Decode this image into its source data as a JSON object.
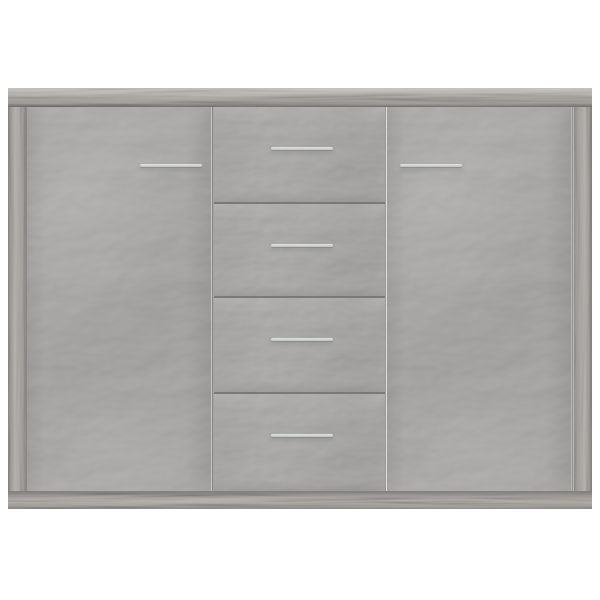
{
  "scene": {
    "description": "Sideboard cabinet in concrete grey, front view, on plain white background",
    "background_color": "#ffffff"
  },
  "cabinet": {
    "finish": "concrete grey",
    "top_board": {
      "name": "top-board"
    },
    "side_panels": [
      {
        "name": "left-side-panel"
      },
      {
        "name": "right-side-panel"
      }
    ],
    "doors": [
      {
        "name": "left-door",
        "handle": "metal-bar-handle"
      },
      {
        "name": "right-door",
        "handle": "metal-bar-handle"
      }
    ],
    "drawers": [
      {
        "name": "drawer-1",
        "handle": "metal-bar-handle"
      },
      {
        "name": "drawer-2",
        "handle": "metal-bar-handle"
      },
      {
        "name": "drawer-3",
        "handle": "metal-bar-handle"
      },
      {
        "name": "drawer-4",
        "handle": "metal-bar-handle"
      }
    ],
    "base_plinth": {
      "name": "base-plinth"
    },
    "colors": {
      "background": "#ffffff",
      "concrete_face": "#a9a7a5",
      "frame_wood": "#a6a39f",
      "gap_line": "#7b7975",
      "gap_line_soft": "#8a8884",
      "plinth_shadow_line": "#85837f",
      "handle_highlight": "#e0e4df",
      "handle_base": "#bdc3bd"
    }
  }
}
